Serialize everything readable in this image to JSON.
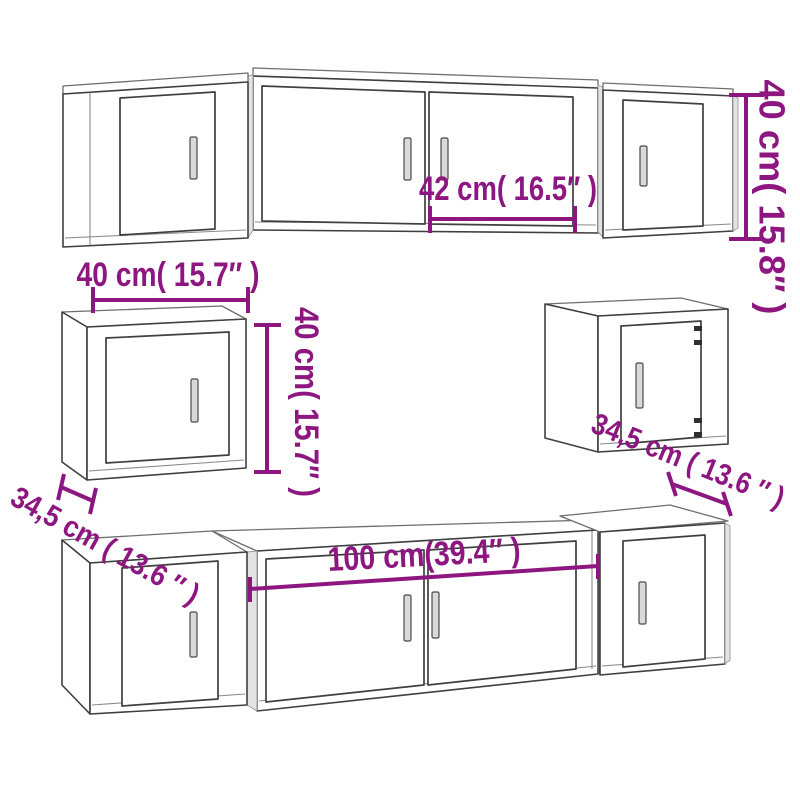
{
  "title": "TV wall cabinet set dimension diagram",
  "colors": {
    "background": "#ffffff",
    "dimension": "#8d1680",
    "outline": "#3f3f3f"
  },
  "dims": {
    "top_door_width": "42 cm( 16.5″ )",
    "top_row_height": "40 cm( 15.8″ )",
    "wall_cab_width": "40 cm( 15.7″ )",
    "wall_cab_height": "40 cm( 15.7″ )",
    "wall_cab_left_depth": "34,5 cm ( 13.6 ″ )",
    "wall_cab_right_depth": "34,5 cm ( 13.6 ″ )",
    "bottom_row_width": "100 cm(39.4″ )"
  }
}
